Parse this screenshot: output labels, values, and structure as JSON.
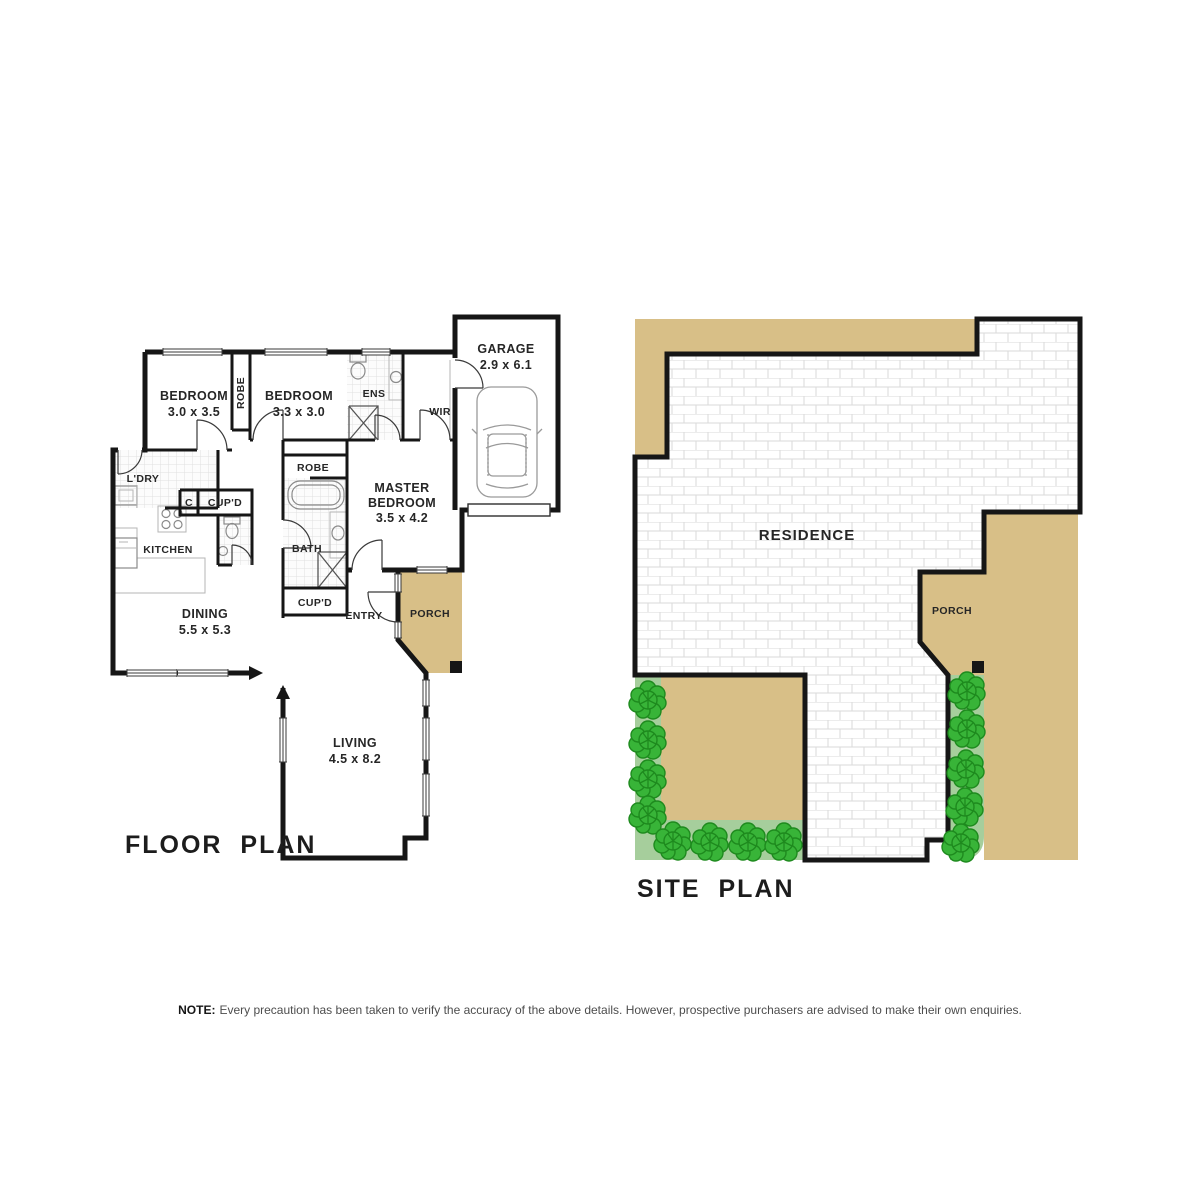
{
  "floor_plan": {
    "title": "FLOOR PLAN",
    "rooms": {
      "bedroom1": {
        "label": "BEDROOM",
        "dims": "3.0 x 3.5"
      },
      "bedroom2": {
        "label": "BEDROOM",
        "dims": "3.3 x 3.0"
      },
      "master": {
        "line1": "MASTER",
        "line2": "BEDROOM",
        "dims": "3.5 x 4.2"
      },
      "garage": {
        "label": "GARAGE",
        "dims": "2.9 x 6.1"
      },
      "dining": {
        "label": "DINING",
        "dims": "5.5 x 5.3"
      },
      "living": {
        "label": "LIVING",
        "dims": "4.5 x 8.2"
      },
      "kitchen": {
        "label": "KITCHEN"
      },
      "bath": {
        "label": "BATH"
      },
      "ens": {
        "label": "ENS"
      },
      "wir": {
        "label": "WIR"
      },
      "ldry": {
        "label": "L'DRY"
      },
      "robe1": {
        "label": "ROBE"
      },
      "robe2": {
        "label": "ROBE"
      },
      "closet": {
        "label": "C"
      },
      "cupd_hall": {
        "label": "CUP'D"
      },
      "cupd_bath": {
        "label": "CUP'D"
      },
      "entry": {
        "label": "ENTRY"
      },
      "porch": {
        "label": "PORCH"
      }
    }
  },
  "site_plan": {
    "title": "SITE PLAN",
    "labels": {
      "residence": "RESIDENCE",
      "porch": "PORCH"
    }
  },
  "note": {
    "prefix": "NOTE:",
    "body": "Every precaution has been taken to verify the accuracy of the above details. However, prospective purchasers are advised to make their own enquiries."
  },
  "colors": {
    "paving_tan": "#d8bf87",
    "lawn_green": "#a6ce9c",
    "tree_green": "#38b438",
    "wall_black": "#161616"
  }
}
